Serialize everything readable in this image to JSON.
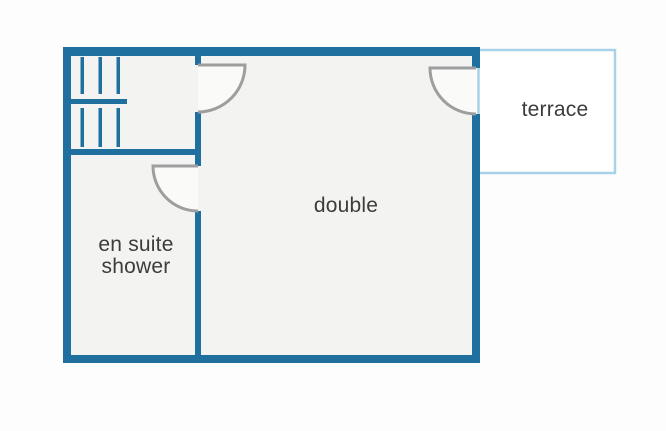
{
  "diagram": {
    "type": "floor-plan",
    "rooms": {
      "double": {
        "label": "double"
      },
      "en_suite_shower": {
        "label": "en suite\nshower"
      },
      "terrace": {
        "label": "terrace"
      }
    },
    "symbols": [
      "stairs-icon",
      "door-swing-stairs-to-double",
      "door-swing-double-to-terrace",
      "door-swing-double-to-en-suite"
    ],
    "colors": {
      "wall": "#1f6f9f",
      "terrace_border": "#a7d2e7",
      "door": "#9e9e9e",
      "room_fill": "#f3f3f1",
      "terrace_fill": "#ffffff",
      "text": "#3c3c3c",
      "background": "#fdfdfd"
    }
  }
}
